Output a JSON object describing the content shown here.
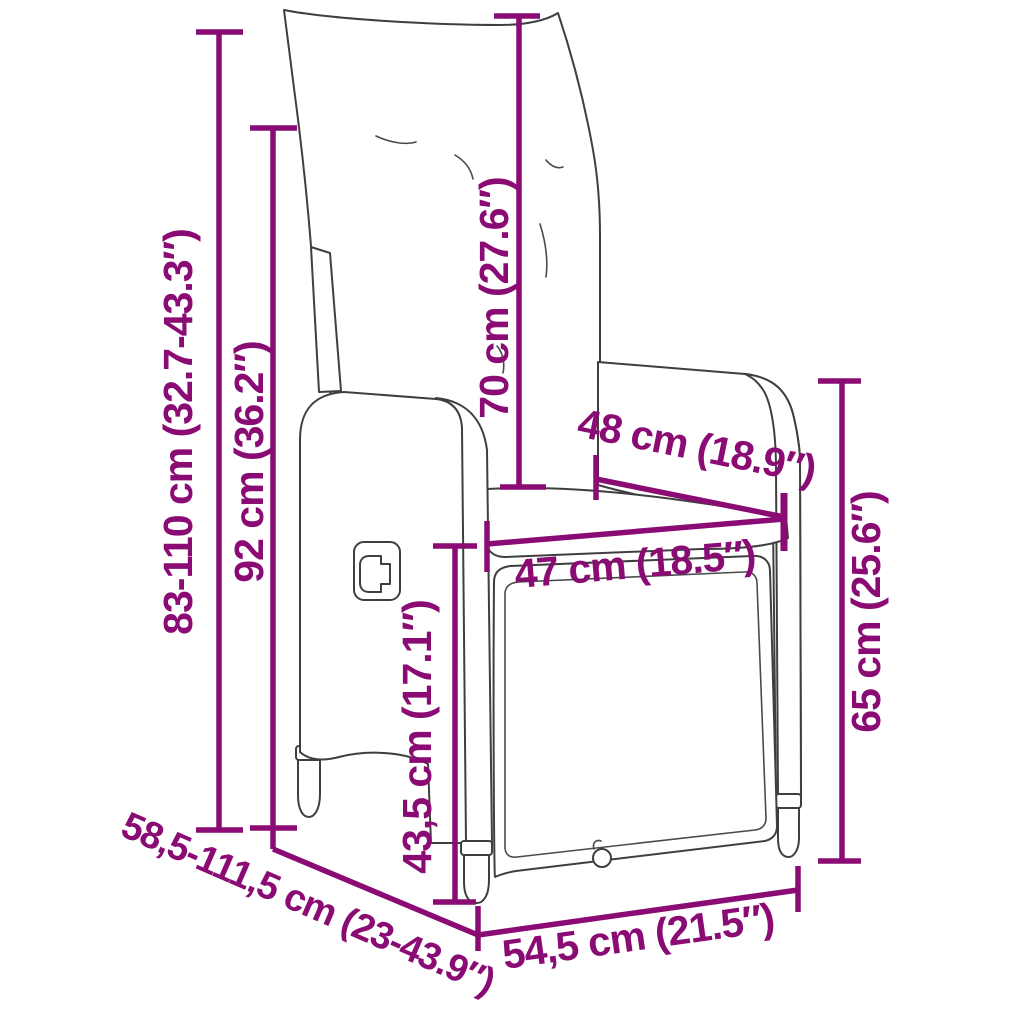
{
  "diagram": {
    "subject": "reclining wicker garden chair with cushions, technical dimension drawing",
    "background_color": "#ffffff",
    "dimension_color": "#8a0b74",
    "linework_color": "#3f3f3f",
    "dimensions": [
      {
        "id": "backrest-height-range",
        "text": "83-110 cm (32.7-43.3″)",
        "orientation": "vertical-left-outer"
      },
      {
        "id": "frame-height",
        "text": "92 cm (36.2″)",
        "orientation": "vertical-left-inner"
      },
      {
        "id": "back-cushion-height",
        "text": "70 cm (27.6″)",
        "orientation": "vertical-center"
      },
      {
        "id": "inner-width-top",
        "text": "48 cm (18.9″)",
        "orientation": "diagonal-seatback"
      },
      {
        "id": "seat-width",
        "text": "47 cm (18.5″)",
        "orientation": "horizontal-seat"
      },
      {
        "id": "armrest-height",
        "text": "65 cm (25.6″)",
        "orientation": "vertical-right"
      },
      {
        "id": "seat-height",
        "text": "43,5 cm (17.1″)",
        "orientation": "vertical-front"
      },
      {
        "id": "depth-range",
        "text": "58,5-111,5 cm (23-43.9″)",
        "orientation": "diagonal-bottom-left"
      },
      {
        "id": "base-width",
        "text": "54,5 cm (21.5″)",
        "orientation": "horizontal-bottom"
      }
    ]
  }
}
